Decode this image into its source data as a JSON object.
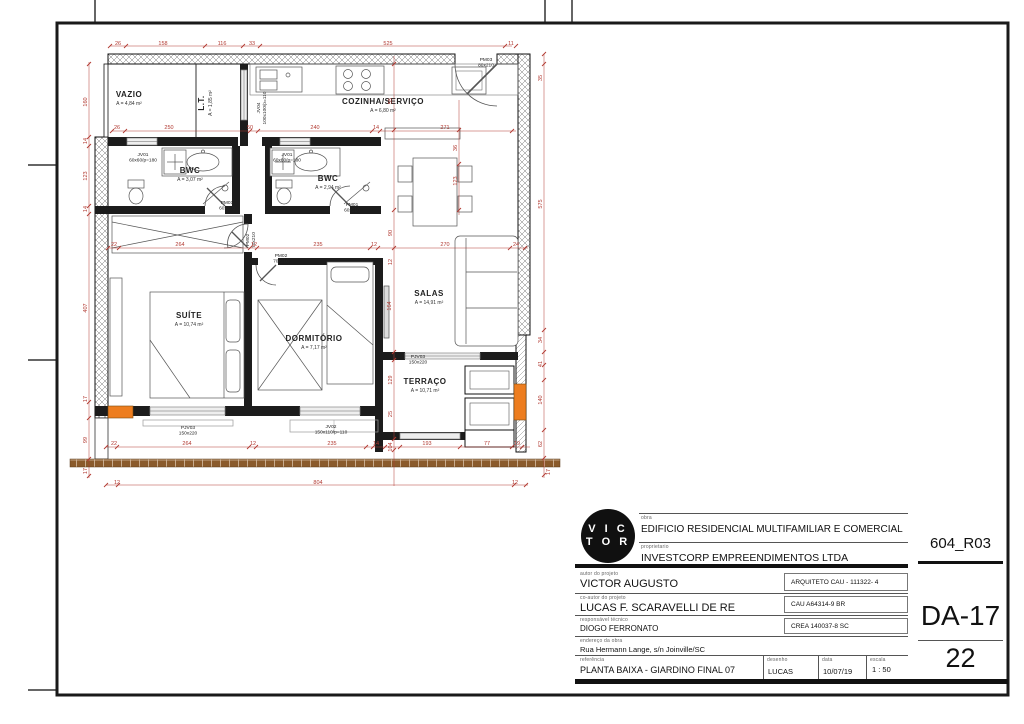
{
  "title_block": {
    "logo_top": "V I C",
    "logo_bottom": "T O R",
    "obra_label": "obra",
    "obra": "EDIFICIO RESIDENCIAL MULTIFAMILIAR E COMERCIAL",
    "proprietario_label": "proprietario",
    "proprietario": "INVESTCORP EMPREENDIMENTOS LTDA",
    "autor_label": "autor do projeto",
    "autor": "VICTOR AUGUSTO",
    "autor_reg": "ARQUITETO CAU - 111322- 4",
    "coautor_label": "co-autor do projeto",
    "coautor": "LUCAS F. SCARAVELLI DE RE",
    "coautor_reg": "CAU A64314-9 BR",
    "resp_label": "responsável técnico",
    "resp": "DIOGO FERRONATO",
    "resp_reg": "CREA 140037-8 SC",
    "endereco_label": "endereço da obra",
    "endereco": "Rua Hermann Lange, s/n Joinville/SC",
    "referencia_label": "referência",
    "referencia": "PLANTA BAIXA - GIARDINO FINAL 07",
    "desenho_label": "desenho",
    "desenho": "LUCAS",
    "data_label": "data",
    "data": "10/07/19",
    "escala_label": "escala",
    "escala": "1 : 50",
    "revisao": "604_R03",
    "folha": "DA-17",
    "numero": "22"
  },
  "colors": {
    "dimension": "#b23a32",
    "wall": "#1a1a1a",
    "column_highlight": "#ed7d1f",
    "brick": "#8a5a2b"
  },
  "plan": {
    "rooms": [
      {
        "name": "VAZIO",
        "area": "A = 4,84 m²",
        "x": 129,
        "y": 97
      },
      {
        "name": "L.T.",
        "area": "A = 1,85 m²",
        "x": 204,
        "y": 103,
        "r": -90
      },
      {
        "name": "COZINHA/SERVIÇO",
        "area": "A = 6,80 m²",
        "x": 383,
        "y": 104
      },
      {
        "name": "BWC",
        "area": "A = 3,07 m²",
        "x": 190,
        "y": 173
      },
      {
        "name": "BWC",
        "area": "A = 2,94 m²",
        "x": 328,
        "y": 181
      },
      {
        "name": "SUÍTE",
        "area": "A = 10,74 m²",
        "x": 189,
        "y": 318
      },
      {
        "name": "DORMITÓRIO",
        "area": "A = 7,17 m²",
        "x": 314,
        "y": 341
      },
      {
        "name": "SALAS",
        "area": "A = 14,91 m²",
        "x": 429,
        "y": 296
      },
      {
        "name": "TERRAÇO",
        "area": "A = 10,71 m²",
        "x": 425,
        "y": 384
      }
    ],
    "tags": [
      {
        "l1": "JV01",
        "l2": "60x60/p=180",
        "x": 143,
        "y": 156
      },
      {
        "l1": "JV01",
        "l2": "60x60/p=180",
        "x": 287,
        "y": 156
      },
      {
        "l1": "PM01",
        "l2": "60x210",
        "x": 227,
        "y": 204
      },
      {
        "l1": "PM01",
        "l2": "60x210",
        "x": 352,
        "y": 206
      },
      {
        "l1": "PM02",
        "l2": "70x210",
        "x": 249,
        "y": 240,
        "r": -90
      },
      {
        "l1": "PM02",
        "l2": "70x210",
        "x": 281,
        "y": 257
      },
      {
        "l1": "PM03",
        "l2": "80x210",
        "x": 486,
        "y": 61
      },
      {
        "l1": "JV04",
        "l2": "100x100/p=110",
        "x": 260,
        "y": 108,
        "r": -90
      },
      {
        "l1": "PJV03",
        "l2": "150x220",
        "x": 418,
        "y": 358
      },
      {
        "l1": "PJV03",
        "l2": "150x220",
        "x": 188,
        "y": 429
      },
      {
        "l1": "JV02",
        "l2": "150x110/p=110",
        "x": 331,
        "y": 428
      }
    ],
    "dims": [
      {
        "t": "26",
        "x": 118,
        "y": 45
      },
      {
        "t": "158",
        "x": 163,
        "y": 45
      },
      {
        "t": "116",
        "x": 222,
        "y": 45
      },
      {
        "t": "33",
        "x": 252,
        "y": 45
      },
      {
        "t": "525",
        "x": 388,
        "y": 45
      },
      {
        "t": "11",
        "x": 511,
        "y": 45
      },
      {
        "t": "26",
        "x": 117,
        "y": 129
      },
      {
        "t": "250",
        "x": 169,
        "y": 129
      },
      {
        "t": "50",
        "x": 250,
        "y": 129
      },
      {
        "t": "240",
        "x": 315,
        "y": 129
      },
      {
        "t": "14",
        "x": 376,
        "y": 129
      },
      {
        "t": "271",
        "x": 445,
        "y": 129
      },
      {
        "t": "22",
        "x": 114,
        "y": 246
      },
      {
        "t": "264",
        "x": 180,
        "y": 246
      },
      {
        "t": "12",
        "x": 254,
        "y": 246
      },
      {
        "t": "235",
        "x": 318,
        "y": 246
      },
      {
        "t": "12",
        "x": 374,
        "y": 246
      },
      {
        "t": "270",
        "x": 445,
        "y": 246
      },
      {
        "t": "24",
        "x": 516,
        "y": 246
      },
      {
        "t": "22",
        "x": 114,
        "y": 445
      },
      {
        "t": "264",
        "x": 187,
        "y": 445
      },
      {
        "t": "12",
        "x": 253,
        "y": 445
      },
      {
        "t": "235",
        "x": 332,
        "y": 445
      },
      {
        "t": "14",
        "x": 376,
        "y": 445
      },
      {
        "t": "104",
        "x": 392,
        "y": 447,
        "r": -90
      },
      {
        "t": "193",
        "x": 427,
        "y": 445
      },
      {
        "t": "77",
        "x": 487,
        "y": 445
      },
      {
        "t": "19",
        "x": 517,
        "y": 445
      },
      {
        "t": "12",
        "x": 117,
        "y": 484
      },
      {
        "t": "804",
        "x": 318,
        "y": 484
      },
      {
        "t": "12",
        "x": 515,
        "y": 484
      },
      {
        "t": "160",
        "x": 87,
        "y": 102,
        "r": -90
      },
      {
        "t": "14",
        "x": 87,
        "y": 141,
        "r": -90
      },
      {
        "t": "123",
        "x": 87,
        "y": 176,
        "r": -90
      },
      {
        "t": "14",
        "x": 87,
        "y": 209,
        "r": -90
      },
      {
        "t": "407",
        "x": 87,
        "y": 308,
        "r": -90
      },
      {
        "t": "17",
        "x": 87,
        "y": 399,
        "r": -90
      },
      {
        "t": "99",
        "x": 87,
        "y": 440,
        "r": -90
      },
      {
        "t": "17",
        "x": 87,
        "y": 471,
        "r": -90
      },
      {
        "t": "35",
        "x": 542,
        "y": 78,
        "r": -90
      },
      {
        "t": "575",
        "x": 542,
        "y": 204,
        "r": -90
      },
      {
        "t": "34",
        "x": 542,
        "y": 340,
        "r": -90
      },
      {
        "t": "41",
        "x": 542,
        "y": 364,
        "r": -90
      },
      {
        "t": "140",
        "x": 542,
        "y": 400,
        "r": -90
      },
      {
        "t": "62",
        "x": 542,
        "y": 444,
        "r": -90
      },
      {
        "t": "17",
        "x": 550,
        "y": 472,
        "r": -90
      },
      {
        "t": "55",
        "x": 392,
        "y": 101,
        "r": -90
      },
      {
        "t": "90",
        "x": 392,
        "y": 233,
        "r": -90
      },
      {
        "t": "12",
        "x": 392,
        "y": 262,
        "r": -90
      },
      {
        "t": "164",
        "x": 391,
        "y": 306,
        "r": -90
      },
      {
        "t": "129",
        "x": 392,
        "y": 380,
        "r": -90
      },
      {
        "t": "25",
        "x": 392,
        "y": 414,
        "r": -90
      },
      {
        "t": "36",
        "x": 457,
        "y": 148,
        "r": -90
      },
      {
        "t": "123",
        "x": 457,
        "y": 181,
        "r": -90
      }
    ]
  }
}
